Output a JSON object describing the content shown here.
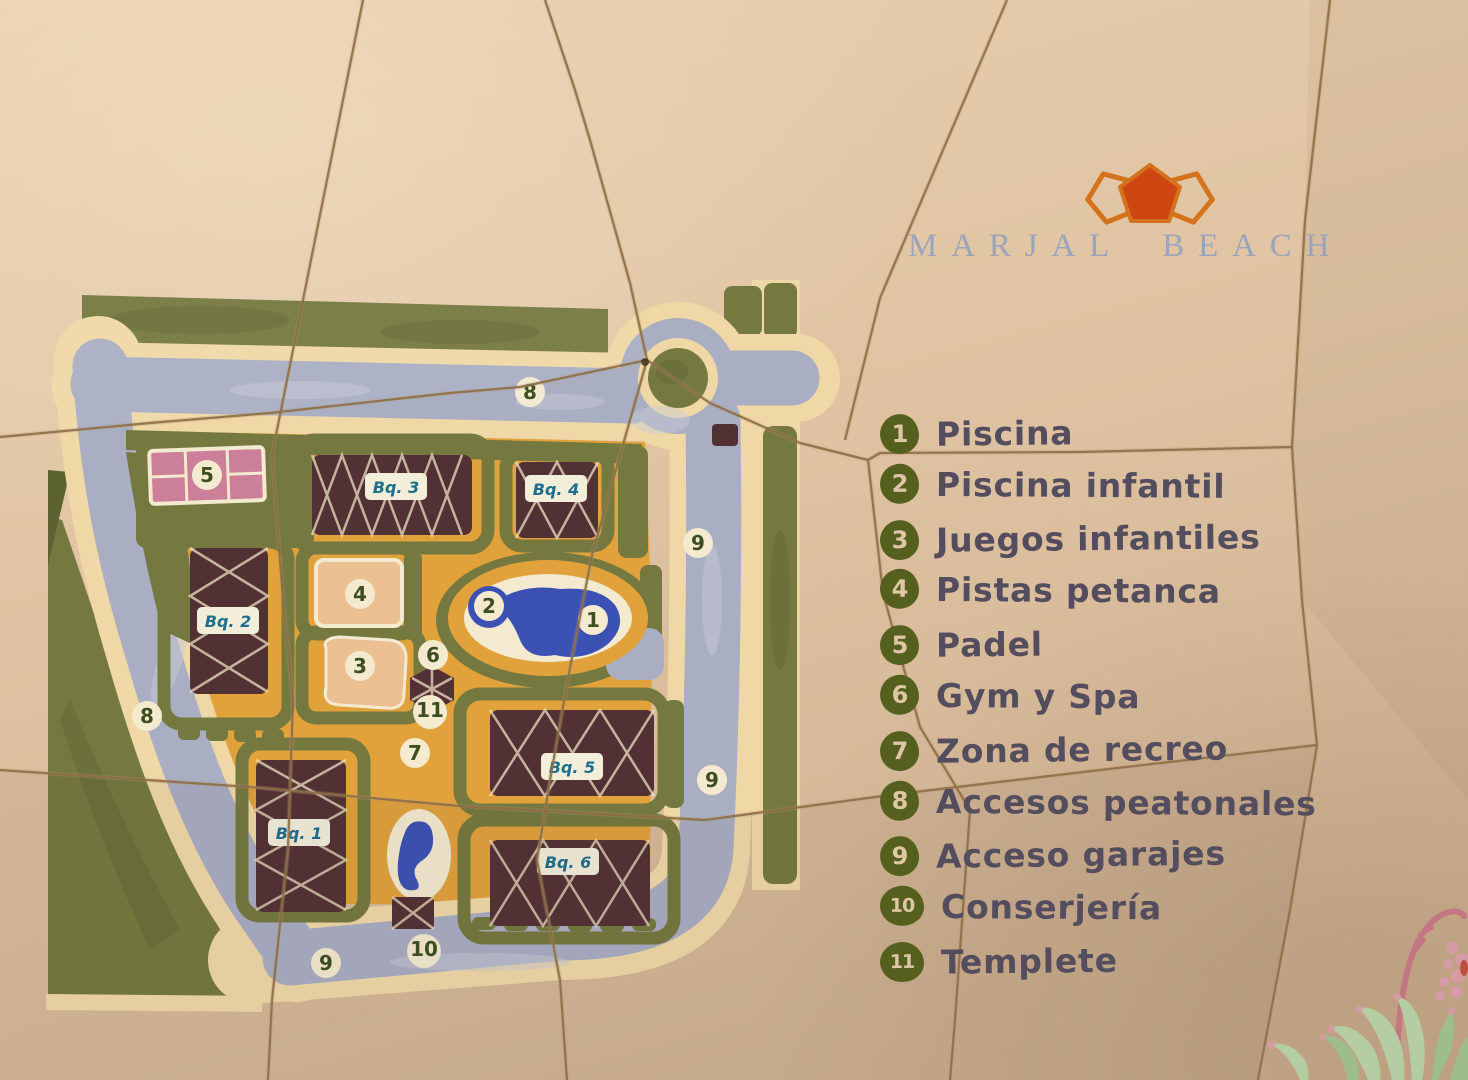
{
  "brand": {
    "name": "MARJAL BEACH"
  },
  "legend": {
    "items": [
      {
        "num": "1",
        "label": "Piscina"
      },
      {
        "num": "2",
        "label": "Piscina infantil"
      },
      {
        "num": "3",
        "label": "Juegos infantiles"
      },
      {
        "num": "4",
        "label": "Pistas petanca"
      },
      {
        "num": "5",
        "label": "Padel"
      },
      {
        "num": "6",
        "label": "Gym y Spa"
      },
      {
        "num": "7",
        "label": "Zona de recreo"
      },
      {
        "num": "8",
        "label": "Accesos peatonales"
      },
      {
        "num": "9",
        "label": "Acceso garajes"
      },
      {
        "num": "10",
        "label": "Conserjería"
      },
      {
        "num": "11",
        "label": "Templete"
      }
    ]
  },
  "map": {
    "building_labels": [
      {
        "text": "Bq. 2",
        "x": 228,
        "y": 621
      },
      {
        "text": "Bq. 3",
        "x": 396,
        "y": 487
      },
      {
        "text": "Bq. 4",
        "x": 556,
        "y": 489
      },
      {
        "text": "Bq. 1",
        "x": 299,
        "y": 833
      },
      {
        "text": "Bq. 5",
        "x": 572,
        "y": 767
      },
      {
        "text": "Bq. 6",
        "x": 568,
        "y": 862
      }
    ],
    "markers": [
      {
        "n": "1",
        "x": 593,
        "y": 620
      },
      {
        "n": "2",
        "x": 489,
        "y": 606
      },
      {
        "n": "3",
        "x": 360,
        "y": 666
      },
      {
        "n": "4",
        "x": 360,
        "y": 594
      },
      {
        "n": "5",
        "x": 207,
        "y": 475
      },
      {
        "n": "6",
        "x": 433,
        "y": 655
      },
      {
        "n": "7",
        "x": 415,
        "y": 753
      },
      {
        "n": "8",
        "x": 530,
        "y": 392
      },
      {
        "n": "8",
        "x": 147,
        "y": 716
      },
      {
        "n": "9",
        "x": 698,
        "y": 543
      },
      {
        "n": "9",
        "x": 712,
        "y": 780
      },
      {
        "n": "9",
        "x": 326,
        "y": 963
      },
      {
        "n": "10",
        "x": 424,
        "y": 951
      },
      {
        "n": "11",
        "x": 430,
        "y": 712
      }
    ]
  },
  "palette": {
    "wall": "#dfc3a2",
    "grout": "#8d6e47",
    "mapGreen": "#75793f",
    "mapGreenDark": "#5d6231",
    "cream": "#f0d8a6",
    "road": "#a9aec3",
    "roadLight": "#c9ccd8",
    "orange": "#e1a23c",
    "building": "#523135",
    "buildingLine": "#ecdfc2",
    "pool": "#3b52b4",
    "pink": "#cc7f98",
    "peach": "#edc093",
    "markerBg": "#f3ead0",
    "markerText": "#3e4e20",
    "labelBox": "#f3eeda",
    "labelText": "#1e6e8e",
    "badge": "#55601f",
    "badgeText": "#dfc6a4",
    "legendText": "#544d5e",
    "brandText": "#9aa4bb",
    "logoFill": "#ce4713",
    "logoStroke": "#d4731c",
    "plantLeaf": "#b5cda2",
    "plantLeafDark": "#9dbd8d",
    "plantPink": "#d79ba6",
    "plantStem": "#c27783"
  }
}
